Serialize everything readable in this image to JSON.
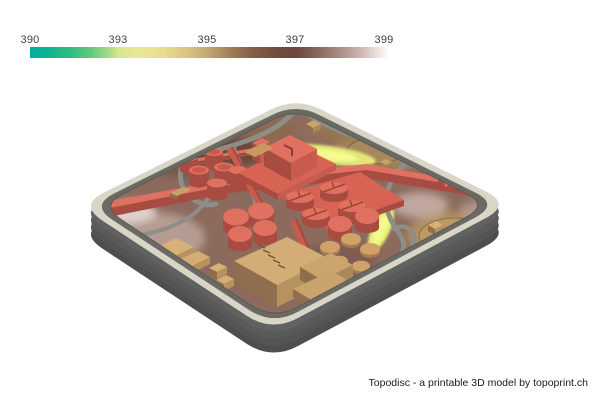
{
  "colorbar": {
    "ticks": [
      "390",
      "393",
      "395",
      "397",
      "399"
    ],
    "tick_positions_px": [
      30,
      118,
      207,
      295,
      384
    ],
    "gradient_stops": [
      {
        "pos": 0.0,
        "color": "#01AE9C"
      },
      {
        "pos": 0.05,
        "color": "#0CB390"
      },
      {
        "pos": 0.11,
        "color": "#2FBC80"
      },
      {
        "pos": 0.17,
        "color": "#62C97E"
      },
      {
        "pos": 0.22,
        "color": "#A5D988"
      },
      {
        "pos": 0.246,
        "color": "#D5E78E"
      },
      {
        "pos": 0.3,
        "color": "#E9E795"
      },
      {
        "pos": 0.37,
        "color": "#E6DE8D"
      },
      {
        "pos": 0.44,
        "color": "#D8C481"
      },
      {
        "pos": 0.494,
        "color": "#C3A873"
      },
      {
        "pos": 0.56,
        "color": "#A07F59"
      },
      {
        "pos": 0.62,
        "color": "#84604B"
      },
      {
        "pos": 0.68,
        "color": "#724E41"
      },
      {
        "pos": 0.74,
        "color": "#6B463D"
      },
      {
        "pos": 0.8,
        "color": "#84655C"
      },
      {
        "pos": 0.86,
        "color": "#A78A83"
      },
      {
        "pos": 0.92,
        "color": "#CBB3AE"
      },
      {
        "pos": 0.97,
        "color": "#EBE0DD"
      },
      {
        "pos": 1.0,
        "color": "#FDFCFC"
      }
    ]
  },
  "model": {
    "type": "3d-topographic-model-render",
    "palette": {
      "rim": "#D9D5C7",
      "side1": "#4E4E4E",
      "side2": "#545454",
      "side3": "#5A5A5A",
      "side4": "#616161",
      "inner_wall": "#6A6A64",
      "terrain_base": "#8C6B5E",
      "road": "#8E8E88",
      "salmon_top": "#E0705F",
      "salmon_mid": "#C75B4D",
      "salmon_side": "#A84B40",
      "salmon_platform": "#D66353",
      "tan_top": "#D4AC75",
      "tan_left": "#8E6E4C",
      "tan_right": "#B6925F",
      "tan_light": "#D8B178",
      "yellow_green": "#E8EF78",
      "pond_tan": "#BC9A63"
    }
  },
  "footer": {
    "credit": "Topodisc - a printable 3D model by topoprint.ch"
  }
}
